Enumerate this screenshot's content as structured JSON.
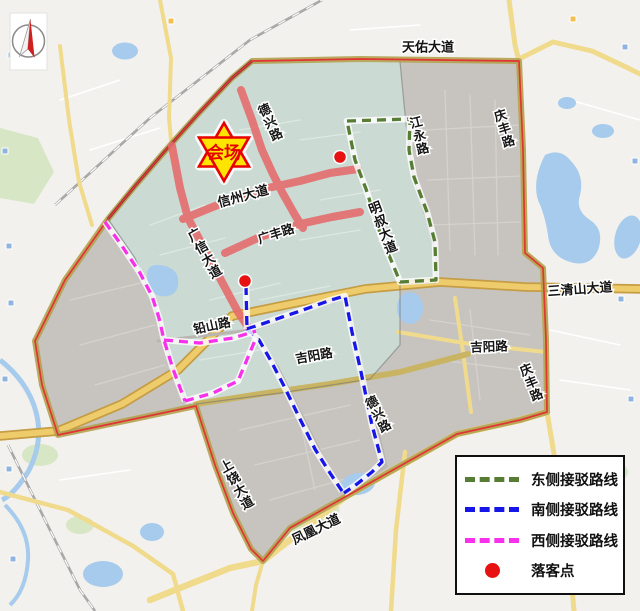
{
  "icons": {
    "compass": "north-compass"
  },
  "venue": {
    "label": "会场"
  },
  "roads": {
    "tianyou": "天佑大道",
    "qingfeng_n": "庆丰路",
    "jiangyong": "江永路",
    "dexing_n": "德兴路",
    "xinzhou": "信州大道",
    "mingshu": "明叔大道",
    "guangxin": "广信大道",
    "guangfeng": "广丰路",
    "sanqingshan": "三清山大道",
    "qianshan": "铅山路",
    "jiyang_w": "吉阳路",
    "jiyang_e": "吉阳路",
    "qingfeng_se": "庆丰路",
    "dexing_s": "德兴路",
    "shangrao": "上饶大道",
    "fenghuang": "凤凰大道"
  },
  "legend": {
    "items": [
      {
        "label": "东侧接驳路线",
        "color": "#567d33",
        "style": "dash"
      },
      {
        "label": "南侧接驳路线",
        "color": "#1616e8",
        "style": "dash"
      },
      {
        "label": "西侧接驳路线",
        "color": "#f830ec",
        "style": "dash"
      },
      {
        "label": "落客点",
        "color": "#e81111",
        "style": "dot"
      }
    ]
  },
  "markers": {
    "drop_point_count": 2
  },
  "colors": {
    "east_route": "#567d33",
    "south_route": "#1616e8",
    "west_route": "#f830ec",
    "drop_point": "#e81111",
    "venue_star_fill": "#ffe400",
    "venue_star_border": "#e80000",
    "highlight_road": "#e66a6c",
    "boundary_line": "#e13434",
    "boundary_band": "#b2a24f",
    "zone_teal": "#cbdbd4",
    "zone_grey": "#c7c4c0",
    "base": "#f3f1ed",
    "water": "#a6cbec",
    "road_yellow": "#f0da8c"
  }
}
